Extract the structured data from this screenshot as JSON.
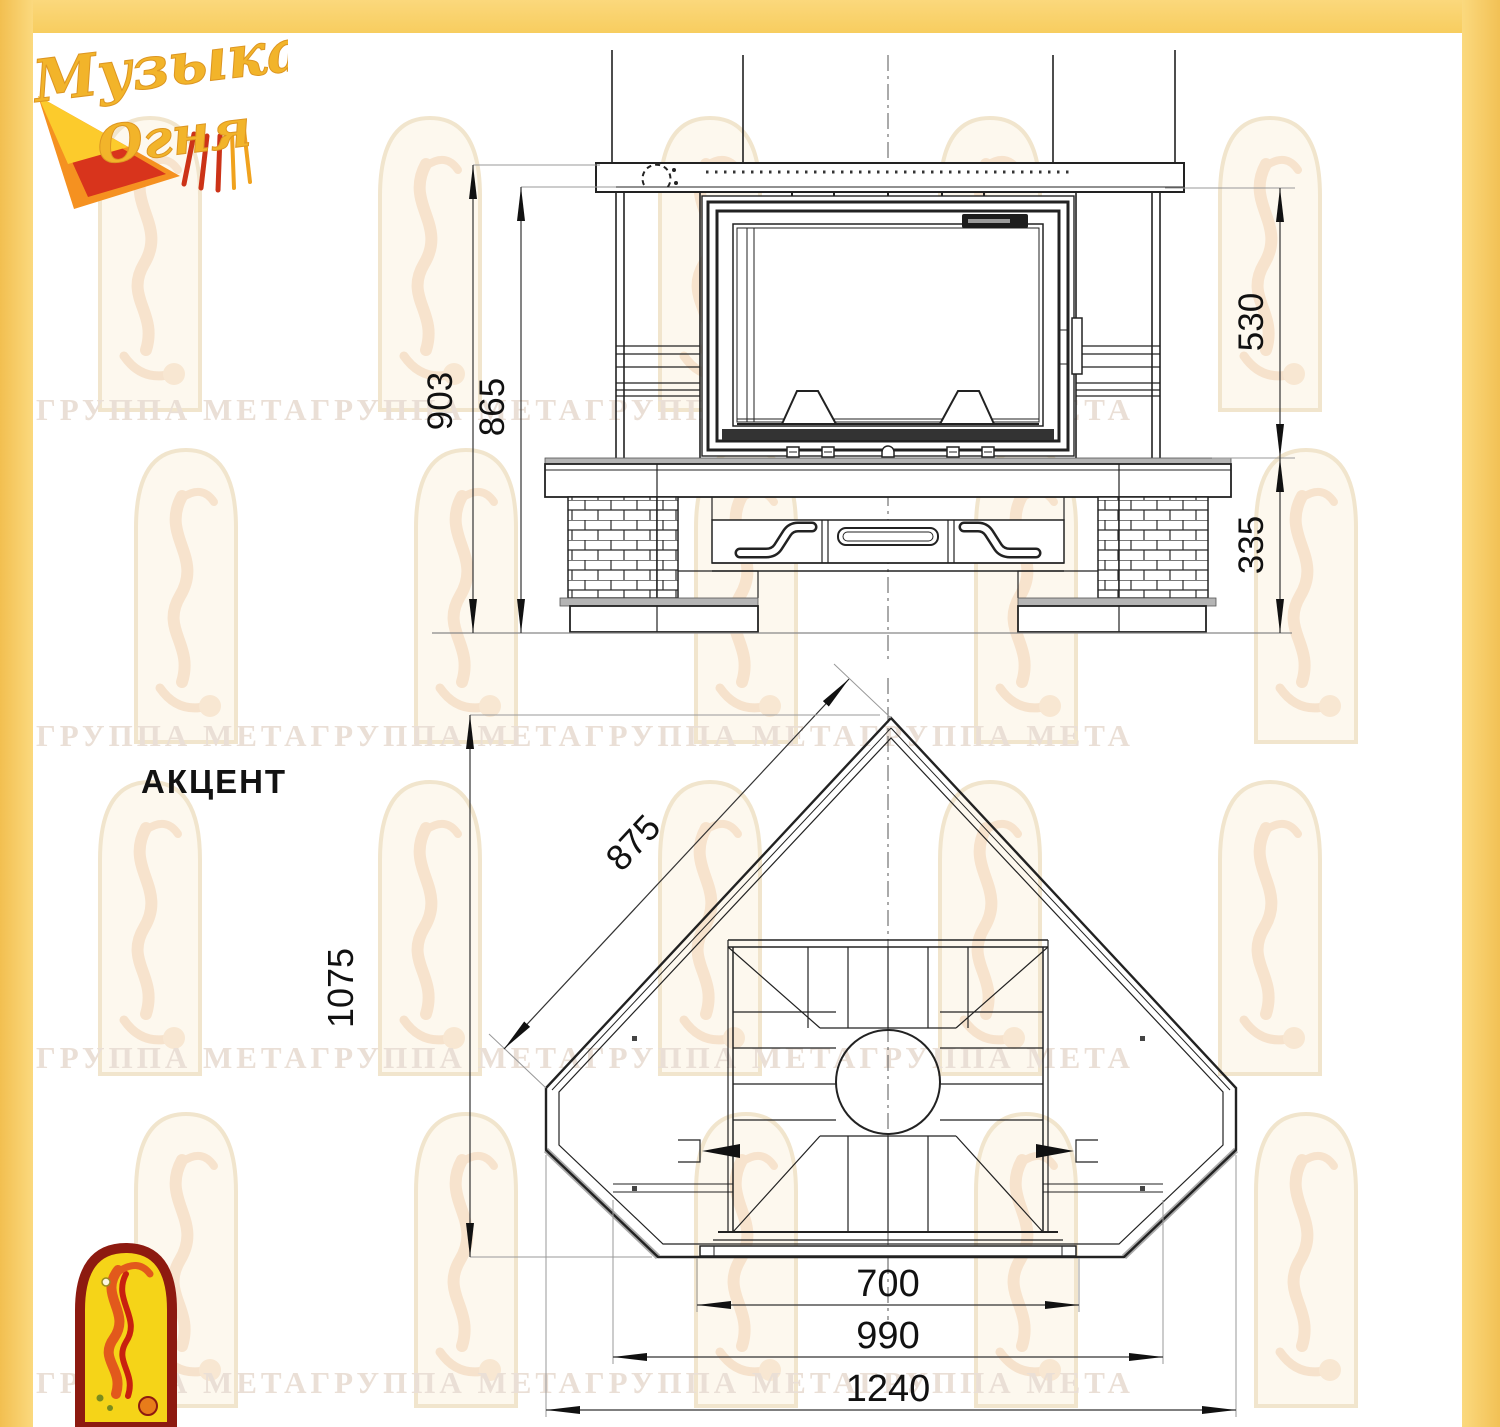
{
  "page": {
    "background": "#ffffff",
    "frame_color": "#f9d069",
    "line_color": "#222222",
    "watermark_color": "#eadfd6"
  },
  "logo": {
    "line1": "Музыка",
    "line2": "Огня"
  },
  "emblem": {
    "name": "flame-dancer-arch"
  },
  "title": "АКЦЕНТ",
  "watermark": {
    "row_text": "ГРУППА МЕТАГРУППА МЕТАГРУППА МЕТАГРУППА МЕТА"
  },
  "front_view": {
    "dims": {
      "total_height": "903",
      "height_under_shelf": "865",
      "firebox_height": "530",
      "base_height": "335"
    }
  },
  "plan_view": {
    "dims": {
      "slope_width": "875",
      "depth": "1075",
      "opening_width": "700",
      "inner_width": "990",
      "total_width": "1240"
    }
  }
}
